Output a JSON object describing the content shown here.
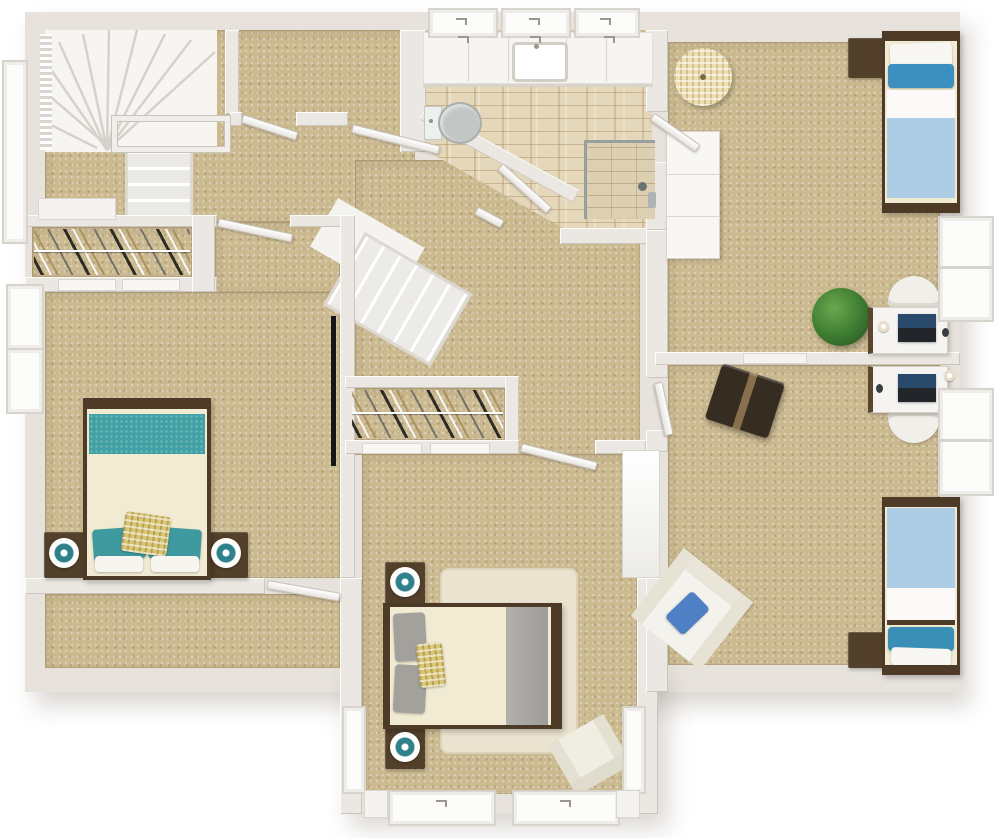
{
  "scene": {
    "type": "3D floor plan, top-down dollhouse view",
    "level": "Upper floor",
    "flooring": "beige carpet with tiled bathroom"
  },
  "palette": {
    "carpet": "#cbb990",
    "wall": "#ebe7e2",
    "wood_dark": "#4e3b27",
    "teal": "#41a0a4",
    "teal_lamp": "#2f828b",
    "blue_pillow": "#3d8fc0",
    "light_blue_blanket": "#accde3",
    "gray_runner": "#a9a7a2",
    "cream_bedding": "#f1ebd3",
    "yellow_check": "#d9c674",
    "tile": "#e5d7ba",
    "plant_green": "#3c7a30",
    "trunk_brown": "#352c22",
    "armchair_cream": "#f0ede2"
  },
  "rooms": [
    {
      "id": "stair-landing",
      "name": "Stair landing",
      "contents": [
        "winder staircase",
        "stair railing",
        "carpeted nook"
      ]
    },
    {
      "id": "hall-closet",
      "name": "Hall closet",
      "contents": [
        "hanging clothes on rod",
        "sliding door panels"
      ]
    },
    {
      "id": "bedroom-1",
      "name": "Bedroom 1 (teal bed)",
      "contents": [
        "double bed with teal runner and pillows",
        "yellow checked accent pillow",
        "two dark wood nightstands",
        "two white table lamps with teal centers",
        "wall mounted TV"
      ]
    },
    {
      "id": "storage-room",
      "name": "Storage room",
      "contents": []
    },
    {
      "id": "center-hall",
      "name": "Center hall",
      "contents": [
        "straight staircase running diagonally"
      ]
    },
    {
      "id": "walk-in-closet",
      "name": "Walk-in closet",
      "contents": [
        "hanging clothes on rod"
      ]
    },
    {
      "id": "bedroom-2",
      "name": "Bedroom 2 (gray bed)",
      "contents": [
        "double bed with gray runner",
        "gray pillows",
        "yellow checked accent pillow",
        "two nightstands with lamps",
        "cream area rug",
        "cream lounge chair",
        "two bottom bay windows",
        "side windows"
      ]
    },
    {
      "id": "bathroom",
      "name": "Bathroom",
      "contents": [
        "vanity counter with sink",
        "toilet",
        "corner walk-in shower with glass",
        "three windows above vanity",
        "tiled floor"
      ]
    },
    {
      "id": "bedroom-3",
      "name": "Bedroom 3 (top right)",
      "contents": [
        "twin bed with blue pillow and light blue blanket",
        "dark wood nightstand",
        "white dresser",
        "round woven pouf",
        "white desk with laptop and mug",
        "white desk chair",
        "green potted plant"
      ]
    },
    {
      "id": "bedroom-4",
      "name": "Bedroom 4 (bottom right)",
      "contents": [
        "twin bed with blue pillow and light blue blanket",
        "dark wood nightstand",
        "white desk with laptop",
        "white desk chair",
        "dark storage trunk",
        "cream armchair with blue pillow"
      ]
    }
  ],
  "fixtures": {
    "windows": [
      "three above bathroom vanity",
      "tall stairwell window left",
      "two on left bedroom wall",
      "two double bays on right wall",
      "two wide bays at bottom",
      "two narrow bays on bedroom-2 side walls"
    ],
    "doors": [
      "nook double doors",
      "hall door",
      "bathroom angled door",
      "bedroom-3 entry door",
      "bedroom-1 entry door",
      "storage room door",
      "bedroom-2 entry door",
      "bedroom-4 hall door",
      "wide open passage to right wing"
    ]
  }
}
